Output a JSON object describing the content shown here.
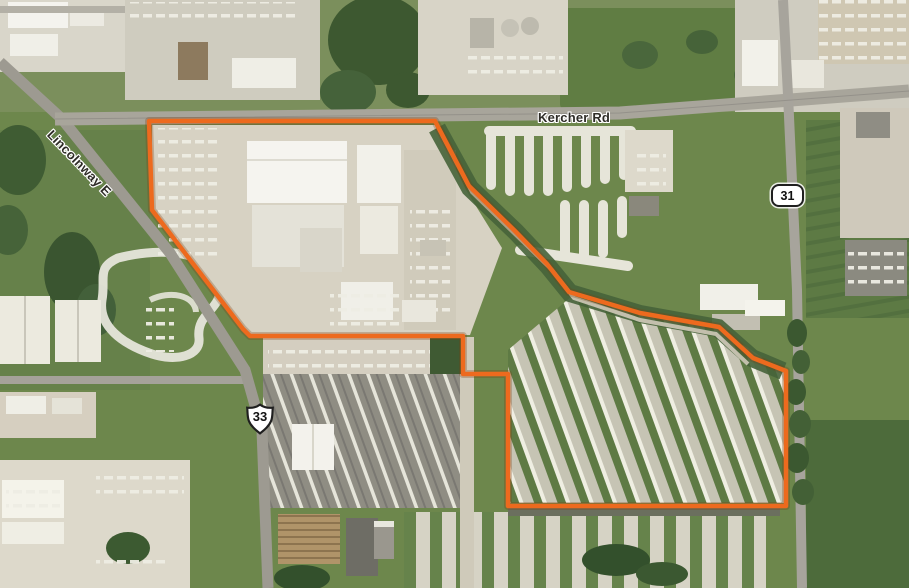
{
  "map": {
    "road_labels": {
      "kercher_rd": "Kercher Rd",
      "lincolnway_e": "Lincolnway E"
    },
    "route_shields": {
      "state_route": "31",
      "us_route": "33"
    },
    "boundary": {
      "color": "#ED6A1E",
      "points": "149,121 435,121 469,186 514,230 547,264 569,292 640,313 719,327 753,358 786,371 786,506 508,506 508,374 463,374 463,336 250,336 243,329 152,210"
    },
    "label_style": {
      "text_color": "#2e2c27",
      "halo_color": "#ffffff"
    }
  }
}
